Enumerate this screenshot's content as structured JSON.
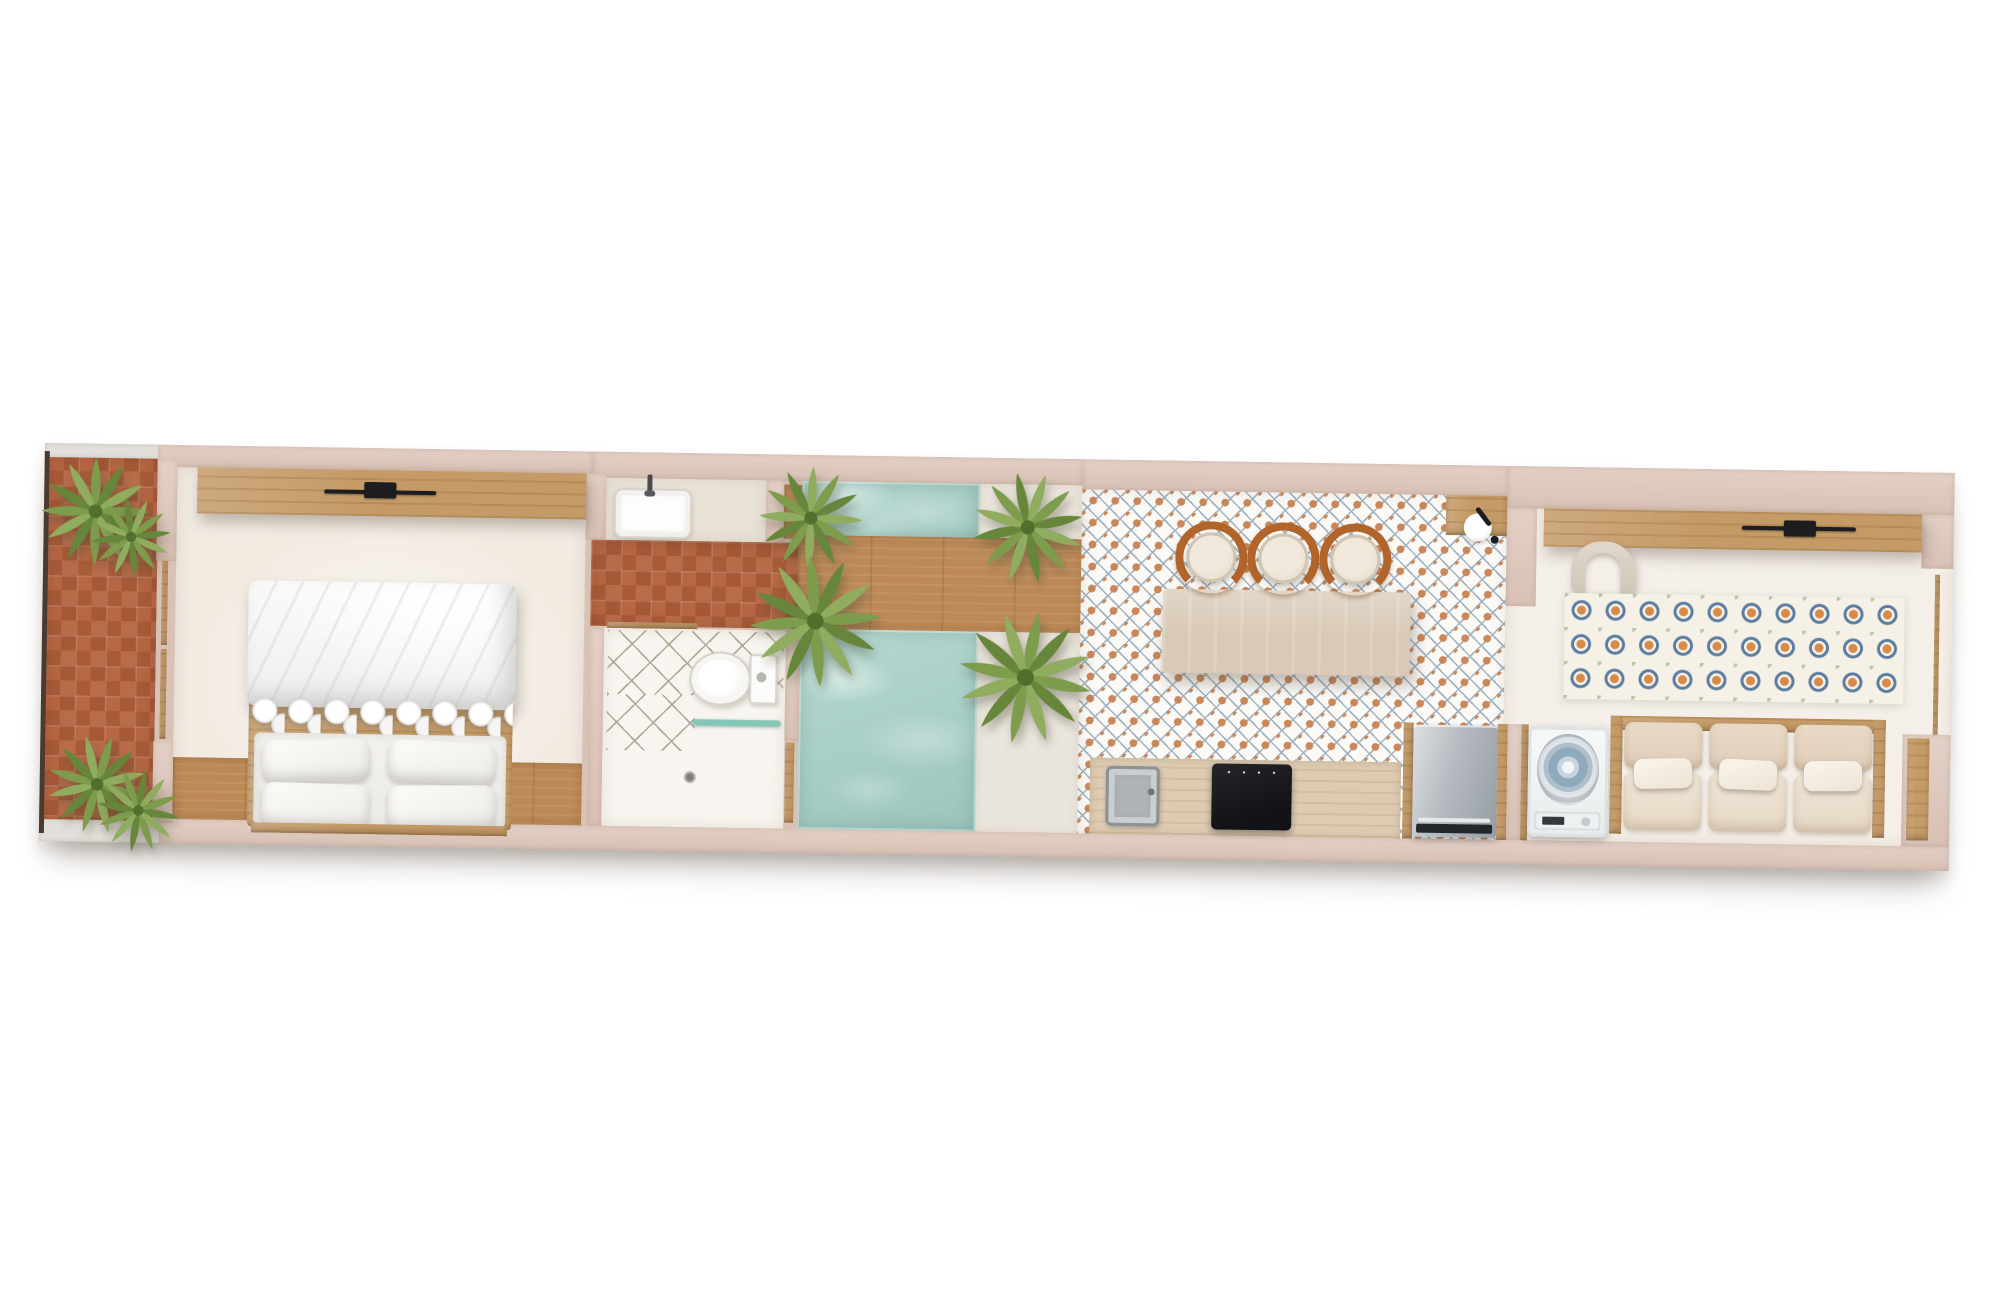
{
  "meta": {
    "title": "studio-apartment-floor-plan-top-view",
    "view": "top-down architectural render, long narrow unit, slightly tilted"
  },
  "colors": {
    "wall": "#d8c1b5",
    "wallLight": "#e4d0c6",
    "terraceWallBand": "#e2dfda",
    "outline": "#4a3a30",
    "terracotta": "#b4613c",
    "woodDeck": "#bd8a57",
    "woodCabinet": "#c49a66",
    "islandWood": "#d9c9b6",
    "counterWood": "#ddcbb2",
    "floorBedroom": "#f2ebe2",
    "floorVanity": "#e9e2d7",
    "floorBath": "#f8f5f0",
    "floorLiving": "#f4efe8",
    "poolside": "#ebe6dd",
    "poolWater": "#aacfc8",
    "poolDeep": "#9cc5bd",
    "poolRipple": "#d6e9e4",
    "tileBase": "#fbfaf7",
    "tileOrange": "#cb8758",
    "tileBlue": "#a4b3c0",
    "latticeLine": "#b3a99b",
    "rugCream": "#f6f1e7",
    "rugOrange": "#d78a4a",
    "rugBlue": "#5b7da0",
    "rugGreen": "#b9c7a6",
    "copper": "#b2652a",
    "glassTeal": "#84c7b6",
    "black": "#1d1d1f",
    "plant1": "#7d9c4c",
    "plant2": "#66873b",
    "plant3": "#90ac5e",
    "plantDark": "#51702e",
    "shadow": "rgba(92,76,62,0.38)"
  },
  "rooms": [
    {
      "id": "terrace",
      "label": "terrace",
      "features": [
        "terracotta-tile-floor",
        "shrub-plant x4",
        "boundary-line"
      ]
    },
    {
      "id": "bedroom",
      "label": "bedroom",
      "features": [
        "wardrobe",
        "wall-tv",
        "double-bed",
        "duvet",
        "pillow x4",
        "wood-floor-strip",
        "sliding-glass-door"
      ]
    },
    {
      "id": "bathroom-suite",
      "label": "bathroom",
      "features": [
        "vanity-sink",
        "faucet",
        "terracotta-hallway",
        "lattice-tile",
        "toilet",
        "shower-glass",
        "floor-drain",
        "door"
      ]
    },
    {
      "id": "pool-courtyard",
      "label": "pool courtyard",
      "features": [
        "plunge-pool-upper",
        "plunge-pool-lower",
        "wood-deck-bridge",
        "pool-step",
        "palm-plant x4"
      ]
    },
    {
      "id": "kitchen-dining",
      "label": "kitchen / dining",
      "features": [
        "moroccan-tile-floor",
        "island",
        "bar-stool x3",
        "wall-faucet",
        "coffee-counter",
        "kitchen-counter",
        "kitchen-sink",
        "cooktop",
        "dishwasher",
        "cabinet-frames"
      ]
    },
    {
      "id": "living-laundry",
      "label": "living / laundry",
      "features": [
        "media-console",
        "wall-tv",
        "armchair",
        "patterned-rug",
        "washing-machine",
        "three-seat-sofa",
        "sofa-pillow x3",
        "side-console",
        "window-strip"
      ]
    }
  ]
}
